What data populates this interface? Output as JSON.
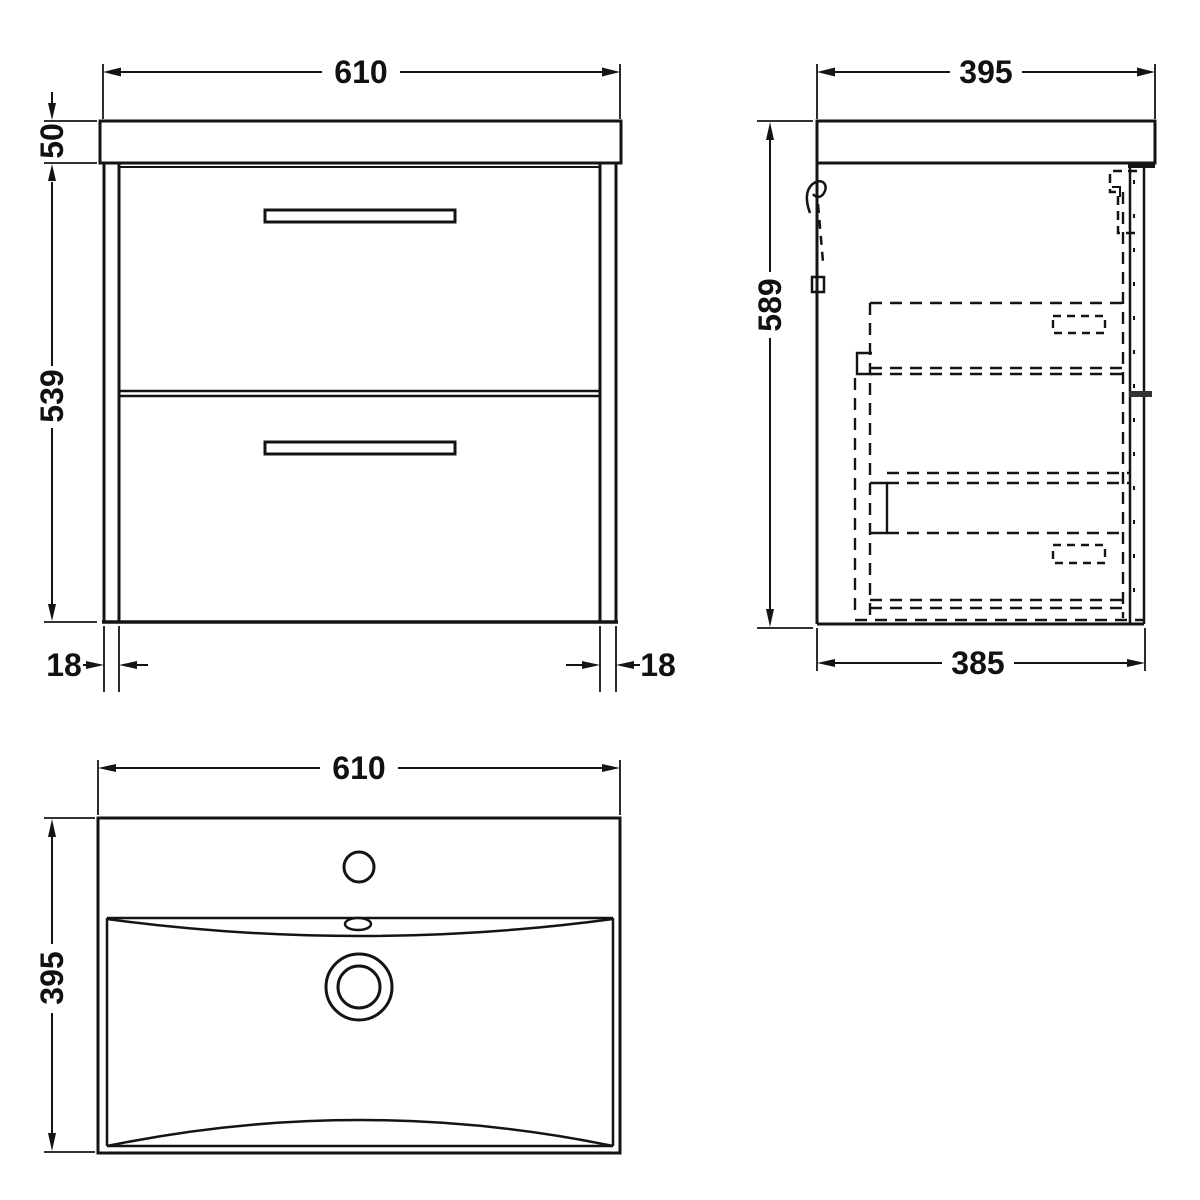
{
  "drawing": {
    "background": "#ffffff",
    "line_color": "#141414",
    "views": {
      "front": {
        "width_mm": "610",
        "countertop_height_mm": "50",
        "cabinet_height_mm": "539",
        "left_frame_mm": "18",
        "right_frame_mm": "18"
      },
      "side": {
        "depth_mm": "395",
        "height_mm": "589",
        "bottom_depth_mm": "385"
      },
      "plan": {
        "width_mm": "610",
        "depth_mm": "395"
      }
    }
  }
}
